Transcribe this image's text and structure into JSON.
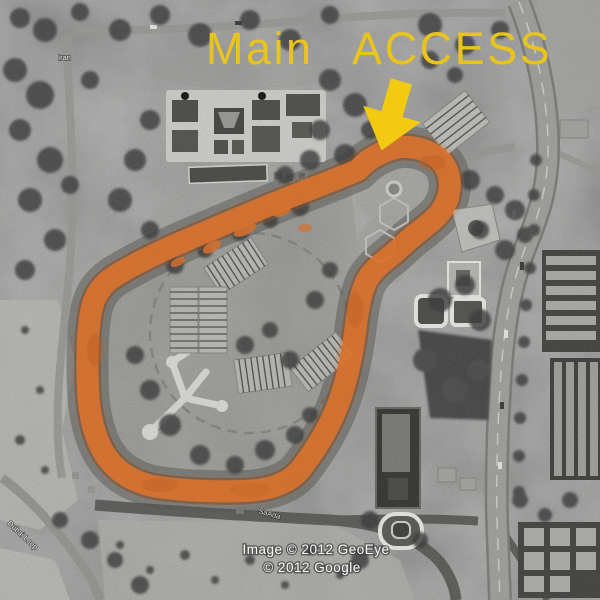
{
  "annotation": {
    "title": "Main ACCESS",
    "title_color": "#e9c41d",
    "arrow_color": "#f2ca12",
    "route_color": "#d8722e"
  },
  "street_labels": {
    "top_left": "Iran",
    "bottom_left": "Dubai Loop",
    "bottom_center": "SaAda"
  },
  "attribution": {
    "line1": "Image © 2012 GeoEye",
    "line2": "© 2012 Google"
  }
}
